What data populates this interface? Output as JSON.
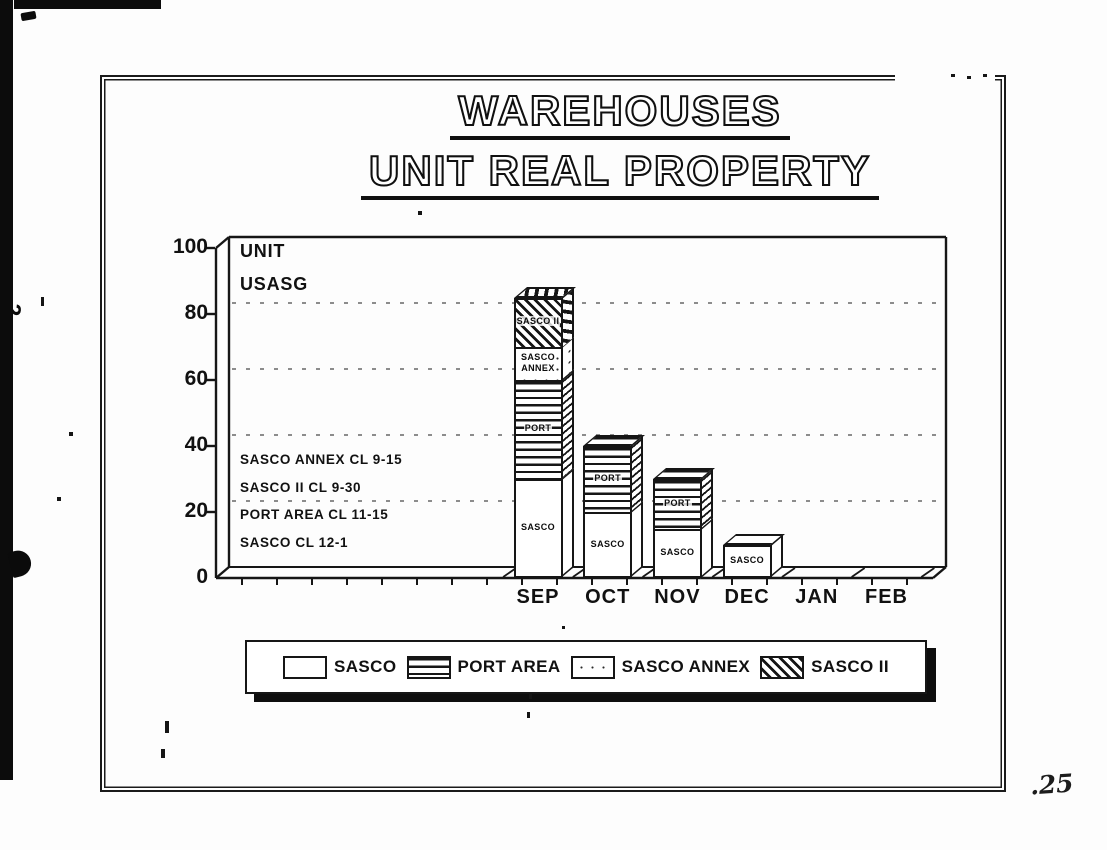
{
  "page": {
    "number": ".25"
  },
  "title": {
    "line1": "WAREHOUSES",
    "line2": "UNIT REAL PROPERTY"
  },
  "margin_mark": "2",
  "chart_data": {
    "type": "bar",
    "stacked": true,
    "three_d": true,
    "title": "WAREHOUSES UNIT REAL PROPERTY",
    "categories": [
      "SEP",
      "OCT",
      "NOV",
      "DEC",
      "JAN",
      "FEB"
    ],
    "series": [
      {
        "name": "SASCO",
        "pattern": "plain",
        "values": [
          30,
          20,
          15,
          10,
          0,
          0
        ]
      },
      {
        "name": "PORT AREA",
        "pattern": "hlines",
        "values": [
          30,
          20,
          15,
          0,
          0,
          0
        ]
      },
      {
        "name": "SASCO ANNEX",
        "pattern": "dots",
        "values": [
          10,
          0,
          0,
          0,
          0,
          0
        ]
      },
      {
        "name": "SASCO II",
        "pattern": "diag",
        "values": [
          15,
          0,
          0,
          0,
          0,
          0
        ]
      }
    ],
    "ylim": [
      0,
      100
    ],
    "yticks": [
      0,
      20,
      40,
      60,
      80,
      100
    ],
    "gridline_values": [
      20,
      40,
      60,
      80
    ],
    "grid_style": "dashed",
    "corner_labels": [
      "UNIT",
      "USASG"
    ],
    "annotations": [
      "SASCO ANNEX CL 9-15",
      "SASCO II CL 9-30",
      "PORT AREA CL 11-15",
      "SASCO CL 12-1"
    ],
    "segment_labels": [
      {
        "category": "SEP",
        "series": "SASCO",
        "lines": [
          "SASCO"
        ]
      },
      {
        "category": "SEP",
        "series": "PORT AREA",
        "lines": [
          "PORT"
        ]
      },
      {
        "category": "SEP",
        "series": "SASCO ANNEX",
        "lines": [
          "SASCO",
          "ANNEX"
        ]
      },
      {
        "category": "SEP",
        "series": "SASCO II",
        "lines": [
          "SASCO II"
        ]
      },
      {
        "category": "OCT",
        "series": "SASCO",
        "lines": [
          "SASCO"
        ]
      },
      {
        "category": "OCT",
        "series": "PORT AREA",
        "lines": [
          "PORT"
        ]
      },
      {
        "category": "NOV",
        "series": "SASCO",
        "lines": [
          "SASCO"
        ]
      },
      {
        "category": "NOV",
        "series": "PORT AREA",
        "lines": [
          "PORT"
        ]
      },
      {
        "category": "DEC",
        "series": "SASCO",
        "lines": [
          "SASCO"
        ]
      }
    ],
    "legend": {
      "position": "bottom",
      "items": [
        "SASCO",
        "PORT AREA",
        "SASCO ANNEX",
        "SASCO II"
      ]
    }
  },
  "colors": {
    "ink": "#161616",
    "paper": "#ffffff"
  }
}
